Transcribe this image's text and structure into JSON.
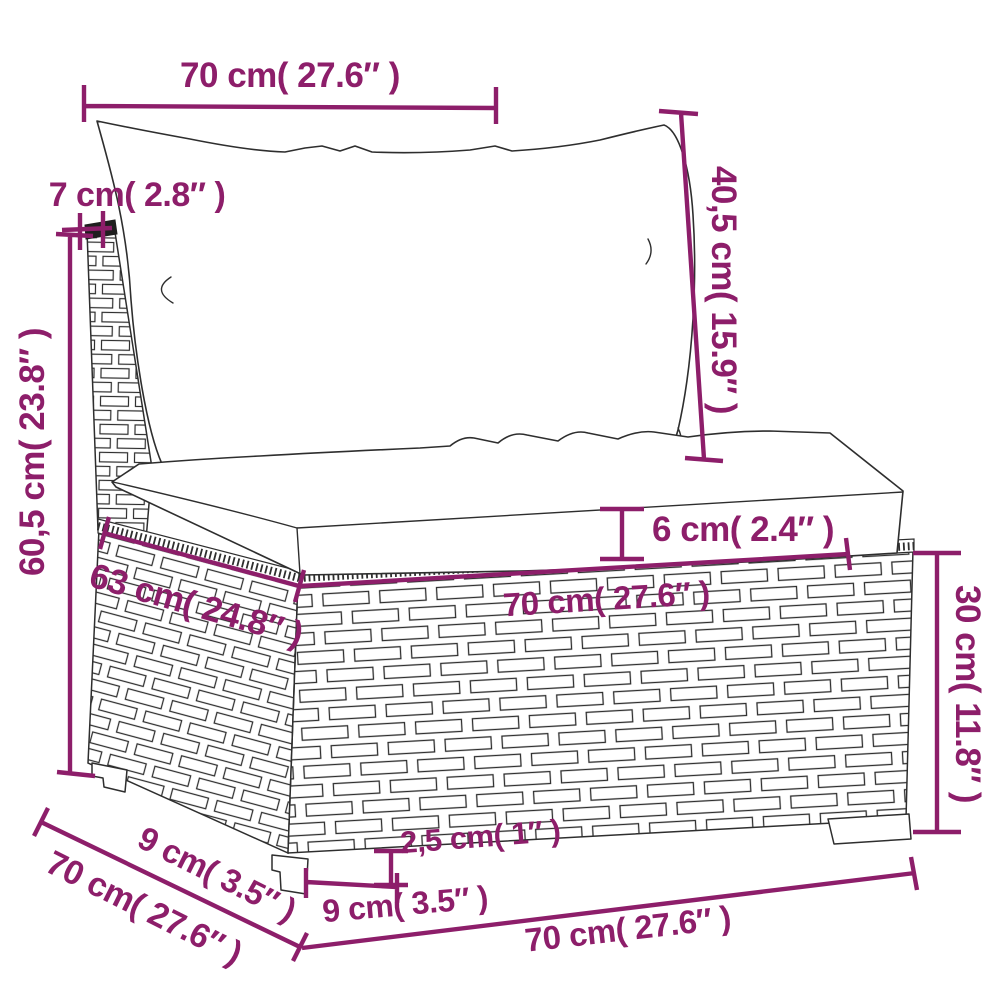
{
  "diagram": {
    "kind": "product dimension diagram",
    "subject": "poly rattan sofa middle section sketch with back cushion and seat cushion",
    "colors": {
      "dimension": "#8d1e6a",
      "sketch": "#2e2e2e",
      "panel_cap": "#1f1f1f",
      "background": "#ffffff"
    },
    "dimensions": {
      "top_width": "70 cm( 27.6″ )",
      "back_panel_thickness": "7 cm( 2.8″ )",
      "back_cushion_height": "40,5 cm( 15.9″ )",
      "overall_height": "60,5 cm( 23.8″ )",
      "seat_depth_top": "63 cm( 24.8″ )",
      "seat_cushion_thickness": "6 cm( 2.4″ )",
      "base_top_width": "70 cm( 27.6″ )",
      "base_height": "30 cm( 11.8″ )",
      "foot_height": "2,5 cm( 1″ )",
      "foot_front_inset": "9 cm( 3.5″ )",
      "total_depth": "70 cm( 27.6″ )",
      "foot_side_inset": "9 cm( 3.5″ )",
      "base_bottom_width": "70 cm( 27.6″ )"
    }
  }
}
